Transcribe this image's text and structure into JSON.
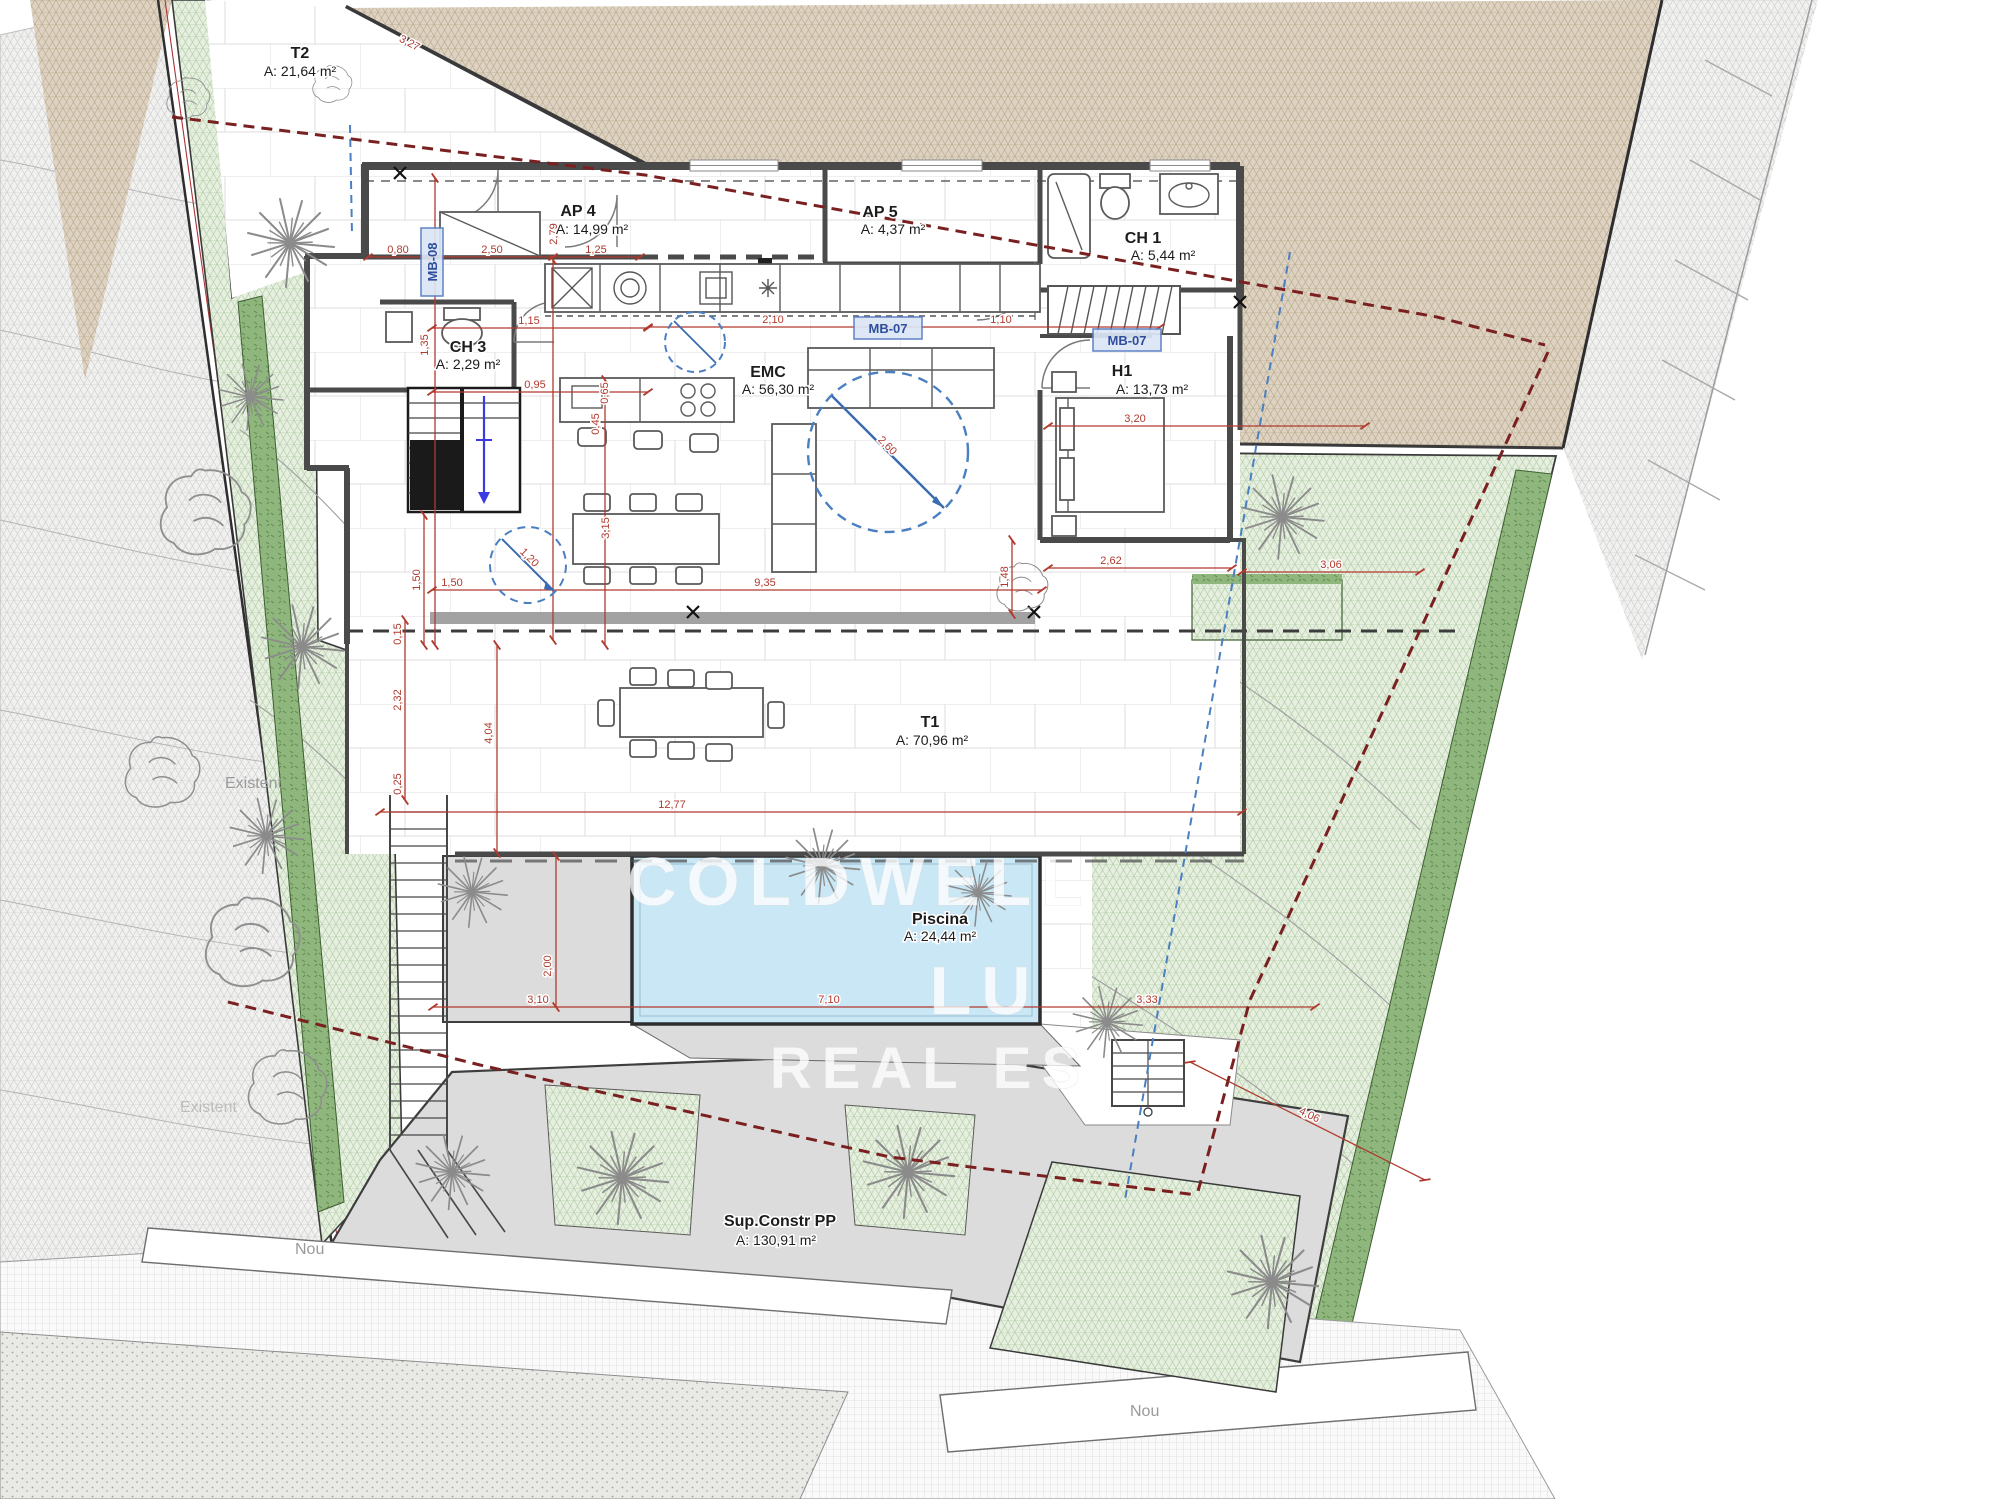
{
  "rooms": [
    {
      "name": "T2",
      "area": "A: 21,64 m²"
    },
    {
      "name": "AP 4",
      "area": "A: 14,99 m²"
    },
    {
      "name": "AP 5",
      "area": "A: 4,37 m²"
    },
    {
      "name": "CH 1",
      "area": "A: 5,44 m²"
    },
    {
      "name": "CH 3",
      "area": "A: 2,29 m²"
    },
    {
      "name": "EMC",
      "area": "A: 56,30 m²"
    },
    {
      "name": "H1",
      "area": "A: 13,73 m²"
    },
    {
      "name": "T1",
      "area": "A: 70,96 m²"
    },
    {
      "name": "Piscina",
      "area": "A: 24,44 m²"
    },
    {
      "name": "Sup.Constr PP",
      "area": "A: 130,91 m²"
    }
  ],
  "tags": {
    "mb07": "MB-07",
    "mb08": "MB-08"
  },
  "site": {
    "existent": "Existent",
    "nou": "Nou",
    "north": "N"
  },
  "watermark": {
    "line1": "COLDWELL",
    "line2": "LU",
    "line3": "REAL ES"
  },
  "dims": [
    "3,27",
    "0,80",
    "2,50",
    "1,25",
    "1,15",
    "0,95",
    "0,65",
    "0,45",
    "3,15",
    "1,50",
    "9,35",
    "4,04",
    "12,77",
    "2,00",
    "3,10",
    "7,10",
    "3,33",
    "4,06",
    "3,20",
    "2,62",
    "3,06",
    "1,10",
    "2,10",
    "1,20",
    "2,60",
    "1,50",
    "1,48",
    "2,32",
    "0,15",
    "0,25",
    "1,35",
    "2,79"
  ],
  "colors": {
    "pool": "#c9e7f5",
    "hedge": "#8fb77d",
    "garden": "#e6efe0",
    "terrain": "#ded3c2",
    "wall": "#4a4a4a",
    "dimension_red": "#b03a2e",
    "boundary_red": "#7a2020",
    "guide_blue": "#4a7fc1",
    "deck_gray": "#dcdcdc"
  }
}
